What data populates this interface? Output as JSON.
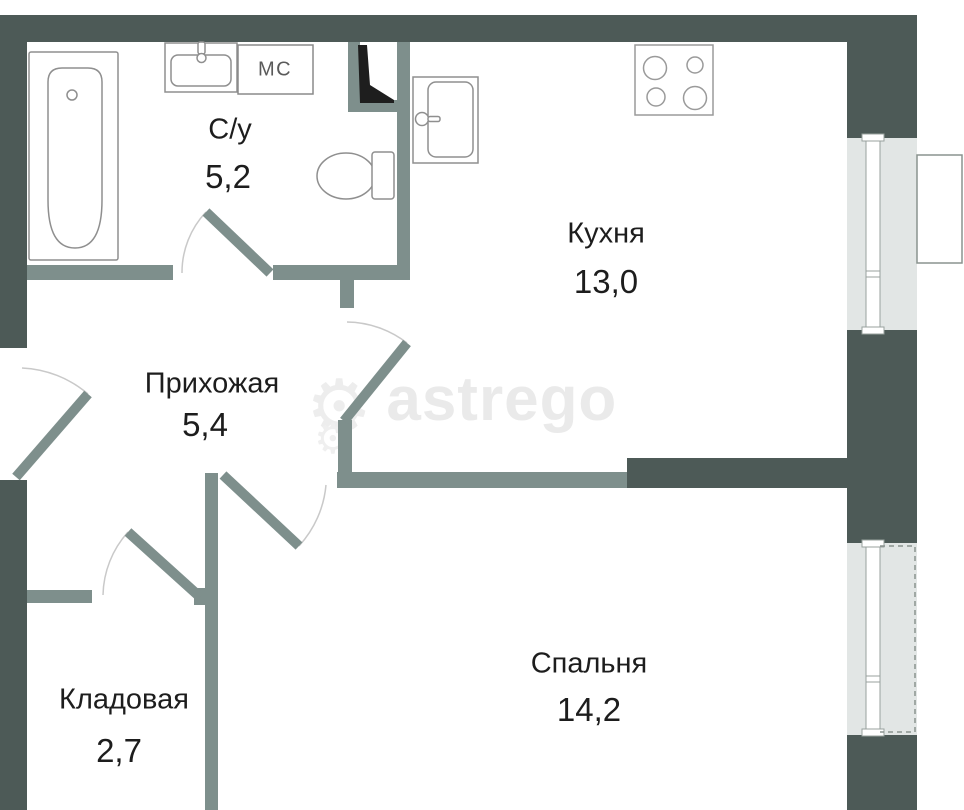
{
  "title": "Floor plan 1-room apartment",
  "watermark": {
    "brand": "astrego",
    "gear_icon": "⚙"
  },
  "rooms": [
    {
      "name": "С/у",
      "area": "5,2"
    },
    {
      "name": "Кухня",
      "area": "13,0"
    },
    {
      "name": "Прихожая",
      "area": "5,4"
    },
    {
      "name": "Кладовая",
      "area": "2,7"
    },
    {
      "name": "Спальня",
      "area": "14,2"
    }
  ],
  "fixtures": {
    "washing_machine_label": "МС",
    "items": [
      "bathtub",
      "bathroom-sink",
      "washing-machine",
      "toilet",
      "vent-shaft",
      "kitchen-sink",
      "stove",
      "window",
      "balcony"
    ]
  },
  "colors": {
    "exterior_wall": "#4d5a57",
    "interior_wall": "#7e8f8c",
    "window_band": "#e2e6e5",
    "fixture_outline": "#8f8f8f",
    "label_text": "#1d1d1d",
    "watermark": "#eaeaea",
    "vent_fill": "#1e1e1e"
  }
}
